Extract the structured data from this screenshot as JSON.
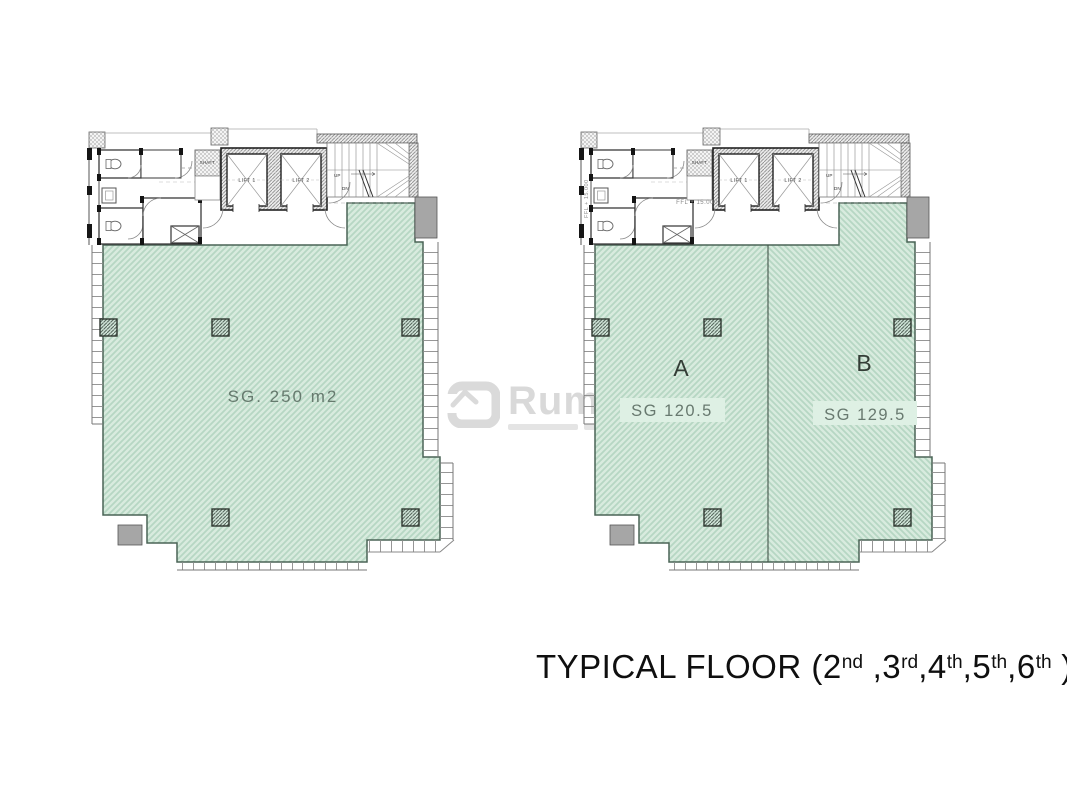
{
  "watermark": {
    "brand": "Rumain"
  },
  "title_parts": [
    {
      "t": "TYPICAL FLOOR (2"
    },
    {
      "t": "nd"
    },
    {
      "t": " ,3"
    },
    {
      "t": "rd"
    },
    {
      "t": ",4"
    },
    {
      "t": "th"
    },
    {
      "t": ",5"
    },
    {
      "t": "th"
    },
    {
      "t": ",6"
    },
    {
      "t": "th"
    },
    {
      "t": " )"
    }
  ],
  "plans": [
    {
      "name": "left-floor-plan",
      "area_label": "SG. 250 m2",
      "core": {
        "lift1": "LIFT 1",
        "lift2": "LIFT 2",
        "shaft": "SHAFT",
        "up": "UP",
        "dn": "DN"
      }
    },
    {
      "name": "right-floor-plan",
      "units": [
        {
          "label": "A",
          "area": "SG 120.5"
        },
        {
          "label": "B",
          "area": "SG 129.5"
        }
      ],
      "ffl": "FFL + 15.000",
      "ffl_side": "FFL + 15.000"
    }
  ],
  "colors": {
    "hatch_bg": "#d8ebde",
    "hatch_line": "#b6d6c3",
    "plan_outline": "#4a6456",
    "wall": "#222222",
    "gray_block": "#a6a6a6",
    "label_green": "#68796f",
    "label_dark": "#333d36",
    "title_text": "#0f0f0f",
    "watermark_gray": "#d9d9d9"
  }
}
